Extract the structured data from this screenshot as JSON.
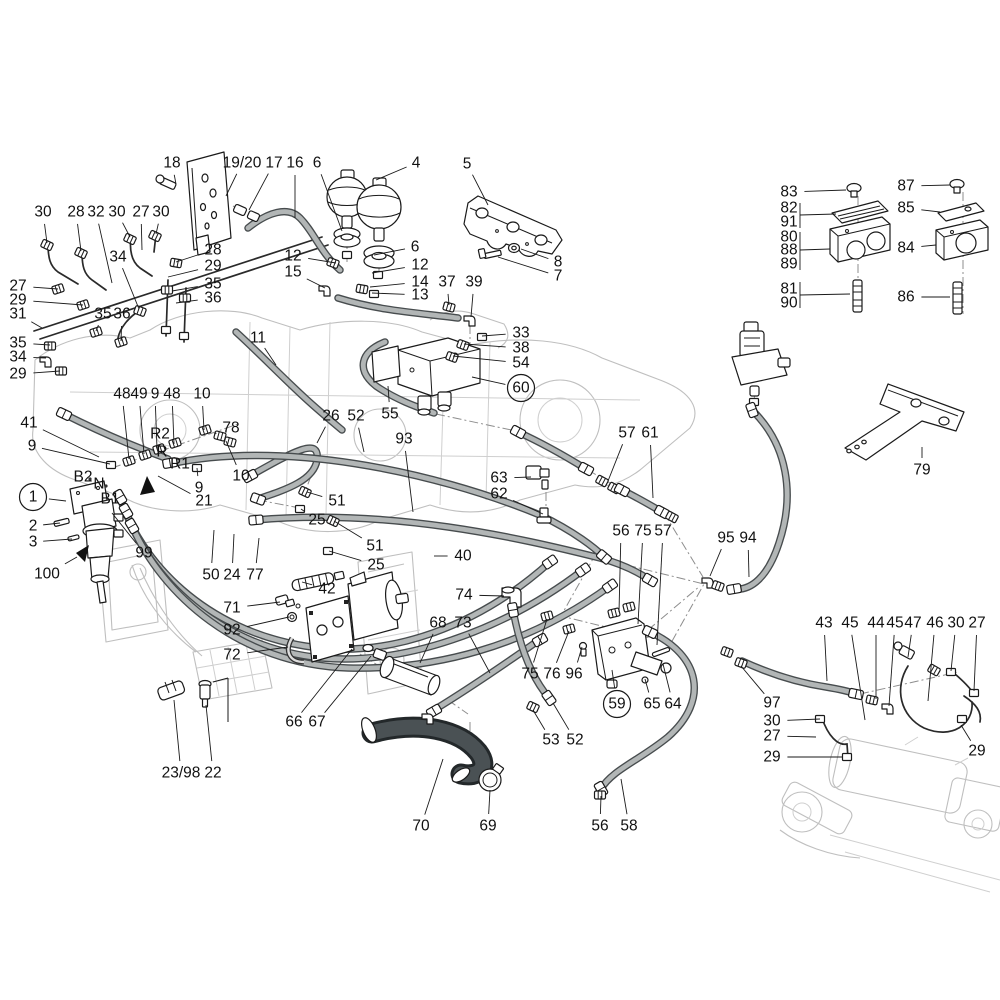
{
  "figure": {
    "kind": "exploded-parts-diagram",
    "subject": "hydraulic brake system with accumulators, brake valve, gear pump and hoses",
    "background": "#ffffff",
    "label_color": "#111111",
    "line_color": "#1a1a1a",
    "hose_outline_color": "#474c4e",
    "hose_fill_color": "#b2b6b6",
    "dark_hose_color": "#23282a",
    "faint_outline_color": "#bfbfbf"
  },
  "callouts": [
    {
      "t": "18",
      "x": 172,
      "y": 163,
      "tx": 176,
      "ty": 184
    },
    {
      "t": "19/20",
      "x": 242,
      "y": 163,
      "tx": 226,
      "ty": 196
    },
    {
      "t": "17",
      "x": 274,
      "y": 163,
      "tx": 249,
      "ty": 210
    },
    {
      "t": "16",
      "x": 295,
      "y": 163,
      "tx": 295,
      "ty": 218
    },
    {
      "t": "6",
      "x": 317,
      "y": 163,
      "tx": 342,
      "ty": 231
    },
    {
      "t": "4",
      "x": 416,
      "y": 163,
      "tx": 376,
      "ty": 180
    },
    {
      "t": "5",
      "x": 467,
      "y": 164,
      "tx": 488,
      "ty": 205
    },
    {
      "t": "8",
      "x": 558,
      "y": 262,
      "tx": 521,
      "ty": 249
    },
    {
      "t": "7",
      "x": 558,
      "y": 276,
      "tx": 498,
      "ty": 257
    },
    {
      "t": "30",
      "x": 43,
      "y": 212,
      "tx": 47,
      "ty": 243
    },
    {
      "t": "28",
      "x": 76,
      "y": 212,
      "tx": 81,
      "ty": 251
    },
    {
      "t": "32",
      "x": 96,
      "y": 212,
      "tx": 112,
      "ty": 283
    },
    {
      "t": "30",
      "x": 117,
      "y": 212,
      "tx": 130,
      "ty": 237
    },
    {
      "t": "27",
      "x": 141,
      "y": 212,
      "tx": 142,
      "ty": 250
    },
    {
      "t": "30",
      "x": 161,
      "y": 212,
      "tx": 156,
      "ty": 234
    },
    {
      "t": "34",
      "x": 118,
      "y": 257,
      "tx": 139,
      "ty": 309
    },
    {
      "t": "28",
      "x": 213,
      "y": 250,
      "tx": 176,
      "ty": 262
    },
    {
      "t": "29",
      "x": 213,
      "y": 266,
      "tx": 168,
      "ty": 277
    },
    {
      "t": "35",
      "x": 213,
      "y": 284,
      "tx": 172,
      "ty": 291
    },
    {
      "t": "36",
      "x": 213,
      "y": 298,
      "tx": 176,
      "ty": 303
    },
    {
      "t": "27",
      "x": 18,
      "y": 286,
      "tx": 58,
      "ty": 289
    },
    {
      "t": "29",
      "x": 18,
      "y": 300,
      "tx": 83,
      "ty": 305
    },
    {
      "t": "31",
      "x": 18,
      "y": 314,
      "tx": 42,
      "ty": 328
    },
    {
      "t": "35",
      "x": 103,
      "y": 314,
      "tx": 96,
      "ty": 331
    },
    {
      "t": "36",
      "x": 122,
      "y": 314,
      "tx": 121,
      "ty": 341
    },
    {
      "t": "35",
      "x": 18,
      "y": 343,
      "tx": 50,
      "ty": 345
    },
    {
      "t": "34",
      "x": 18,
      "y": 357,
      "tx": 46,
      "ty": 358
    },
    {
      "t": "29",
      "x": 18,
      "y": 374,
      "tx": 60,
      "ty": 371
    },
    {
      "t": "12",
      "x": 293,
      "y": 256,
      "tx": 336,
      "ty": 263
    },
    {
      "t": "15",
      "x": 293,
      "y": 272,
      "tx": 325,
      "ty": 288
    },
    {
      "t": "6",
      "x": 415,
      "y": 247,
      "tx": 374,
      "ty": 255
    },
    {
      "t": "12",
      "x": 420,
      "y": 265,
      "tx": 372,
      "ty": 273
    },
    {
      "t": "14",
      "x": 420,
      "y": 282,
      "tx": 370,
      "ty": 287
    },
    {
      "t": "13",
      "x": 420,
      "y": 295,
      "tx": 372,
      "ty": 293
    },
    {
      "t": "37",
      "x": 447,
      "y": 282,
      "tx": 449,
      "ty": 305
    },
    {
      "t": "39",
      "x": 474,
      "y": 282,
      "tx": 471,
      "ty": 317
    },
    {
      "t": "33",
      "x": 521,
      "y": 333,
      "tx": 482,
      "ty": 336
    },
    {
      "t": "38",
      "x": 521,
      "y": 348,
      "tx": 464,
      "ty": 344
    },
    {
      "t": "54",
      "x": 521,
      "y": 363,
      "tx": 453,
      "ty": 356
    },
    {
      "t": "60",
      "x": 521,
      "y": 388,
      "circled": true,
      "tx": 472,
      "ty": 377
    },
    {
      "t": "11",
      "x": 258,
      "y": 338,
      "tx": 276,
      "ty": 365
    },
    {
      "t": "83",
      "x": 789,
      "y": 192,
      "tx": 846,
      "ty": 190
    },
    {
      "t": "82",
      "x": 789,
      "y": 208
    },
    {
      "t": "91",
      "x": 789,
      "y": 222
    },
    {
      "t": "80",
      "x": 789,
      "y": 237
    },
    {
      "t": "88",
      "x": 789,
      "y": 250
    },
    {
      "t": "89",
      "x": 789,
      "y": 264
    },
    {
      "t": "81",
      "x": 789,
      "y": 289
    },
    {
      "t": "90",
      "x": 789,
      "y": 303
    },
    {
      "t": "87",
      "x": 906,
      "y": 186,
      "tx": 950,
      "ty": 185
    },
    {
      "t": "85",
      "x": 906,
      "y": 208,
      "tx": 940,
      "ty": 212
    },
    {
      "t": "84",
      "x": 906,
      "y": 248,
      "tx": 936,
      "ty": 245
    },
    {
      "t": "86",
      "x": 906,
      "y": 297,
      "tx": 950,
      "ty": 297
    },
    {
      "t": "79",
      "x": 922,
      "y": 470,
      "tx": 922,
      "ty": 447
    },
    {
      "t": "26",
      "x": 331,
      "y": 416,
      "tx": 317,
      "ty": 443
    },
    {
      "t": "52",
      "x": 356,
      "y": 416,
      "tx": 364,
      "ty": 452
    },
    {
      "t": "55",
      "x": 390,
      "y": 414,
      "tx": 388,
      "ty": 386
    },
    {
      "t": "93",
      "x": 404,
      "y": 439,
      "tx": 413,
      "ty": 512
    },
    {
      "t": "57",
      "x": 627,
      "y": 433,
      "tx": 608,
      "ty": 481
    },
    {
      "t": "61",
      "x": 650,
      "y": 433,
      "tx": 653,
      "ty": 498
    },
    {
      "t": "63",
      "x": 499,
      "y": 478,
      "tx": 531,
      "ty": 477
    },
    {
      "t": "62",
      "x": 499,
      "y": 494,
      "tx": 543,
      "ty": 514
    },
    {
      "t": "48",
      "x": 122,
      "y": 394,
      "tx": 129,
      "ty": 459
    },
    {
      "t": "49",
      "x": 139,
      "y": 394,
      "tx": 144,
      "ty": 454
    },
    {
      "t": "9",
      "x": 155,
      "y": 394,
      "tx": 157,
      "ty": 449
    },
    {
      "t": "48",
      "x": 172,
      "y": 394,
      "tx": 174,
      "ty": 444
    },
    {
      "t": "10",
      "x": 202,
      "y": 394,
      "tx": 204,
      "ty": 430
    },
    {
      "t": "41",
      "x": 29,
      "y": 423,
      "tx": 99,
      "ty": 457
    },
    {
      "t": "9",
      "x": 32,
      "y": 446,
      "tx": 110,
      "ty": 464
    },
    {
      "t": "R2",
      "x": 160,
      "y": 434
    },
    {
      "t": "78",
      "x": 231,
      "y": 428,
      "tx": 214,
      "ty": 434
    },
    {
      "t": "R",
      "x": 162,
      "y": 452
    },
    {
      "t": "R1",
      "x": 180,
      "y": 464
    },
    {
      "t": "10",
      "x": 241,
      "y": 476,
      "tx": 226,
      "ty": 441
    },
    {
      "t": "9",
      "x": 199,
      "y": 488,
      "tx": 197,
      "ty": 468
    },
    {
      "t": "21",
      "x": 204,
      "y": 501,
      "tx": 158,
      "ty": 476
    },
    {
      "t": "B2",
      "x": 83,
      "y": 477
    },
    {
      "t": "N",
      "x": 99,
      "y": 484
    },
    {
      "t": "B1",
      "x": 110,
      "y": 499
    },
    {
      "t": "1",
      "x": 33,
      "y": 497,
      "circled": true,
      "tx": 66,
      "ty": 501
    },
    {
      "t": "2",
      "x": 33,
      "y": 526,
      "tx": 60,
      "ty": 523
    },
    {
      "t": "3",
      "x": 33,
      "y": 542,
      "tx": 72,
      "ty": 539
    },
    {
      "t": "100",
      "x": 47,
      "y": 574,
      "tx": 77,
      "ty": 557
    },
    {
      "t": "99",
      "x": 144,
      "y": 553,
      "tx": 112,
      "ty": 513
    },
    {
      "t": "50",
      "x": 211,
      "y": 575,
      "tx": 214,
      "ty": 530
    },
    {
      "t": "24",
      "x": 232,
      "y": 575,
      "tx": 234,
      "ty": 534
    },
    {
      "t": "77",
      "x": 255,
      "y": 575,
      "tx": 259,
      "ty": 538
    },
    {
      "t": "51",
      "x": 337,
      "y": 501,
      "tx": 307,
      "ty": 492
    },
    {
      "t": "25",
      "x": 317,
      "y": 520,
      "tx": 301,
      "ty": 509
    },
    {
      "t": "51",
      "x": 375,
      "y": 546,
      "tx": 334,
      "ty": 521
    },
    {
      "t": "25",
      "x": 376,
      "y": 565,
      "tx": 329,
      "ty": 551
    },
    {
      "t": "40",
      "x": 463,
      "y": 556,
      "tx": 434,
      "ty": 556
    },
    {
      "t": "42",
      "x": 327,
      "y": 589,
      "tx": 302,
      "ty": 582
    },
    {
      "t": "74",
      "x": 464,
      "y": 595,
      "tx": 504,
      "ty": 596
    },
    {
      "t": "71",
      "x": 232,
      "y": 608,
      "tx": 280,
      "ty": 602
    },
    {
      "t": "92",
      "x": 232,
      "y": 630,
      "tx": 289,
      "ty": 617
    },
    {
      "t": "72",
      "x": 232,
      "y": 655,
      "tx": 288,
      "ty": 647
    },
    {
      "t": "66",
      "x": 294,
      "y": 722,
      "tx": 352,
      "ty": 649
    },
    {
      "t": "67",
      "x": 317,
      "y": 722,
      "tx": 371,
      "ty": 656
    },
    {
      "t": "68",
      "x": 438,
      "y": 623,
      "tx": 420,
      "ty": 663
    },
    {
      "t": "73",
      "x": 463,
      "y": 623,
      "tx": 490,
      "ty": 673
    },
    {
      "t": "56",
      "x": 621,
      "y": 531,
      "tx": 619,
      "ty": 612
    },
    {
      "t": "75",
      "x": 643,
      "y": 531,
      "tx": 638,
      "ty": 624
    },
    {
      "t": "57",
      "x": 663,
      "y": 531,
      "tx": 657,
      "ty": 645
    },
    {
      "t": "95",
      "x": 726,
      "y": 538,
      "tx": 710,
      "ty": 576
    },
    {
      "t": "94",
      "x": 748,
      "y": 538,
      "tx": 749,
      "ty": 577
    },
    {
      "t": "75",
      "x": 530,
      "y": 674,
      "tx": 547,
      "ty": 619
    },
    {
      "t": "76",
      "x": 552,
      "y": 674,
      "tx": 569,
      "ty": 631
    },
    {
      "t": "96",
      "x": 574,
      "y": 674,
      "tx": 582,
      "ty": 647
    },
    {
      "t": "59",
      "x": 617,
      "y": 704,
      "circled": true,
      "tx": 612,
      "ty": 670
    },
    {
      "t": "65",
      "x": 652,
      "y": 704,
      "tx": 645,
      "ty": 679
    },
    {
      "t": "64",
      "x": 673,
      "y": 704,
      "tx": 663,
      "ty": 664
    },
    {
      "t": "53",
      "x": 551,
      "y": 740,
      "tx": 533,
      "ty": 710
    },
    {
      "t": "52",
      "x": 575,
      "y": 740,
      "tx": 553,
      "ty": 703
    },
    {
      "t": "23/98",
      "x": 181,
      "y": 773,
      "tx": 174,
      "ty": 700
    },
    {
      "t": "22",
      "x": 213,
      "y": 773,
      "tx": 206,
      "ty": 705
    },
    {
      "t": "70",
      "x": 421,
      "y": 826,
      "tx": 443,
      "ty": 759
    },
    {
      "t": "69",
      "x": 488,
      "y": 826,
      "tx": 490,
      "ty": 790
    },
    {
      "t": "56",
      "x": 600,
      "y": 826,
      "tx": 601,
      "ty": 796
    },
    {
      "t": "58",
      "x": 629,
      "y": 826,
      "tx": 621,
      "ty": 779
    },
    {
      "t": "97",
      "x": 772,
      "y": 703,
      "tx": 741,
      "ty": 666
    },
    {
      "t": "30",
      "x": 772,
      "y": 721,
      "tx": 820,
      "ty": 719
    },
    {
      "t": "27",
      "x": 772,
      "y": 736,
      "tx": 816,
      "ty": 737
    },
    {
      "t": "29",
      "x": 772,
      "y": 757,
      "tx": 843,
      "ty": 757
    },
    {
      "t": "43",
      "x": 824,
      "y": 623,
      "tx": 827,
      "ty": 681
    },
    {
      "t": "45",
      "x": 850,
      "y": 623,
      "tx": 865,
      "ty": 720
    },
    {
      "t": "44",
      "x": 876,
      "y": 623,
      "tx": 876,
      "ty": 699
    },
    {
      "t": "45",
      "x": 895,
      "y": 623,
      "tx": 889,
      "ty": 706
    },
    {
      "t": "47",
      "x": 913,
      "y": 623,
      "tx": 908,
      "ty": 657
    },
    {
      "t": "46",
      "x": 935,
      "y": 623,
      "tx": 928,
      "ty": 701
    },
    {
      "t": "30",
      "x": 956,
      "y": 623,
      "tx": 951,
      "ty": 671
    },
    {
      "t": "27",
      "x": 977,
      "y": 623,
      "tx": 974,
      "ty": 691
    },
    {
      "t": "29",
      "x": 977,
      "y": 751,
      "tx": 961,
      "ty": 725
    }
  ],
  "arrows": [
    {
      "name": "direction-arrow-upper",
      "points": "147,476 140,495 155,492"
    },
    {
      "name": "direction-arrow-lower",
      "points": "89,545 76,553 85,562"
    }
  ]
}
